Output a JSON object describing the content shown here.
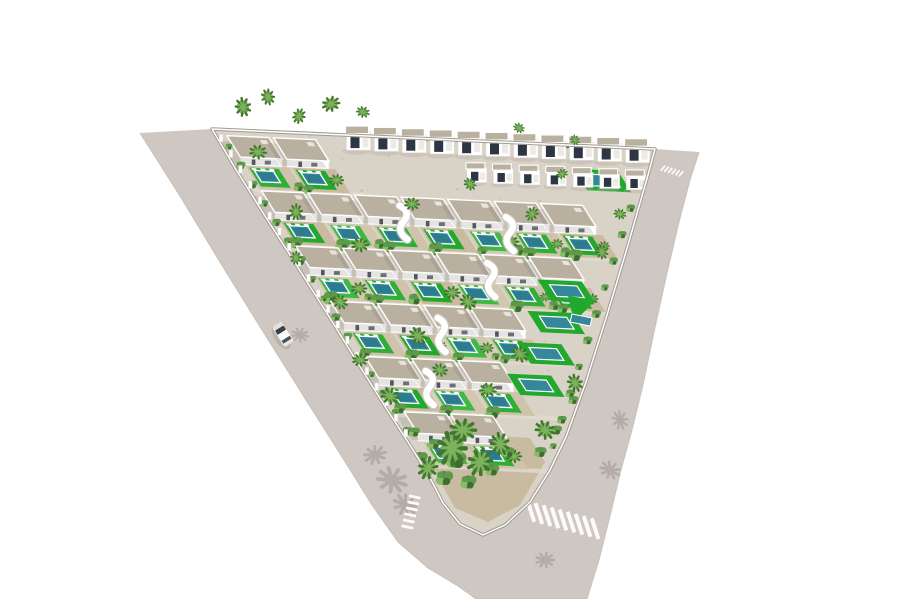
{
  "scene": {
    "type": "3d-architectural-render-aerial-villa-development",
    "canvas": {
      "width": 900,
      "height": 599,
      "background": "#ffffff"
    },
    "seed": 7,
    "colors": {
      "background": "#ffffff",
      "road": "#cfc7c1",
      "roadEdgeLine": "#c2bab3",
      "curb": "#a29a92",
      "curbHighlight": "#ffffff",
      "devStreet": "#d9d2c7",
      "streetBand": "#e1dbd0",
      "sand": [
        "#cfc3ab",
        "#c8bb9f",
        "#d3c7b0"
      ],
      "lawn": [
        "#2fae38",
        "#23a82e",
        "#3db944"
      ],
      "pool": "#35879a",
      "poolDeep": "#2a7487",
      "roof": "#b9b09f",
      "roofBox": "#e9e5dc",
      "facade": "#ffffff",
      "facadeEdge": "#e4e1da",
      "window": "#2d3642",
      "palmDark": "#41762f",
      "palmLight": "#7cb25c",
      "bush1": "#4e8a3f",
      "bush2": "#5e9a4a",
      "bush3": "#8abb66",
      "bush4": "#3c6e30",
      "shadow": "#6f6963",
      "houseShadow": "#b4aba1",
      "carBody": "#f2f1ef",
      "carTrim": "#b9b6b1",
      "carGlass": "#3a4149",
      "stripe": "#ffffff"
    },
    "grid": {
      "origin": [
        212,
        129
      ],
      "u": [
        44.3,
        2.0
      ],
      "v": [
        21.6,
        34.5
      ]
    },
    "devBoundary": [
      [
        212,
        129
      ],
      [
        655,
        149
      ],
      [
        648,
        175
      ],
      [
        628,
        245
      ],
      [
        607,
        315
      ],
      [
        586,
        382
      ],
      [
        566,
        437
      ],
      [
        550,
        470
      ],
      [
        530,
        502
      ],
      [
        505,
        525
      ],
      [
        483,
        535
      ],
      [
        460,
        524
      ],
      [
        443,
        503
      ],
      [
        428,
        474
      ],
      [
        408,
        442
      ],
      [
        386,
        408
      ],
      [
        359,
        365
      ],
      [
        328,
        315
      ],
      [
        297,
        266
      ],
      [
        265,
        216
      ],
      [
        235,
        168
      ]
    ],
    "roadOuter": [
      [
        140,
        133
      ],
      [
        180,
        196
      ],
      [
        226,
        272
      ],
      [
        262,
        330
      ],
      [
        306,
        400
      ],
      [
        344,
        460
      ],
      [
        372,
        505
      ],
      [
        398,
        542
      ],
      [
        428,
        568
      ],
      [
        458,
        586
      ],
      [
        476,
        599
      ],
      [
        587,
        599
      ],
      [
        599,
        560
      ],
      [
        610,
        516
      ],
      [
        621,
        470
      ],
      [
        632,
        430
      ],
      [
        643,
        385
      ],
      [
        654,
        332
      ],
      [
        667,
        273
      ],
      [
        679,
        222
      ],
      [
        690,
        180
      ],
      [
        699,
        152
      ]
    ],
    "rows": [
      {
        "v": 0.18,
        "u0": 0.25,
        "count": 2
      },
      {
        "v": 1.78,
        "u0": 0.25,
        "count": 7
      },
      {
        "v": 3.38,
        "u0": 0.25,
        "count": 6
      },
      {
        "v": 4.98,
        "u0": 0.25,
        "count": 4
      },
      {
        "v": 6.58,
        "u0": 0.25,
        "count": 3
      },
      {
        "v": 8.18,
        "u0": 0.35,
        "count": 2
      }
    ],
    "villa": {
      "pitch": 1.05,
      "roofW": 0.95,
      "roofD": 0.62,
      "facadeDrop": 8
    },
    "backHouses": {
      "v": 0.12,
      "u0": 3.0,
      "pitch": 0.63,
      "count": 11,
      "s": 1.0
    },
    "backHouses2": {
      "v": 0.98,
      "u0": 5.3,
      "pitch": 0.6,
      "count": 7,
      "s": 0.82
    },
    "edgePools": [
      1.0,
      4.35,
      5.3,
      6.25,
      7.2
    ],
    "greenTriangle": [
      [
        568,
        296
      ],
      [
        596,
        300
      ],
      [
        574,
        322
      ]
    ],
    "trianglePool": [
      [
        572,
        314
      ],
      [
        592,
        318
      ],
      [
        590,
        326
      ],
      [
        570,
        322
      ]
    ],
    "tipGardenPoly": [
      [
        432,
        432
      ],
      [
        530,
        438
      ],
      [
        545,
        462
      ],
      [
        520,
        505
      ],
      [
        488,
        522
      ],
      [
        455,
        508
      ],
      [
        436,
        474
      ]
    ],
    "stairs": [
      [
        3.15,
        2.5
      ],
      [
        4.35,
        4.1
      ],
      [
        2.4,
        5.8
      ],
      [
        5.45,
        2.7
      ],
      [
        1.35,
        7.4
      ]
    ],
    "palms": [
      [
        243,
        107,
        1.0
      ],
      [
        268,
        97,
        0.85
      ],
      [
        299,
        116,
        0.8
      ],
      [
        331,
        104,
        0.95
      ],
      [
        363,
        112,
        0.7
      ],
      [
        519,
        128,
        0.6
      ],
      [
        575,
        140,
        0.55
      ],
      [
        360,
        245,
        0.9
      ],
      [
        412,
        204,
        0.8
      ],
      [
        470,
        184,
        0.7
      ],
      [
        532,
        214,
        0.75
      ],
      [
        562,
        174,
        0.6
      ],
      [
        296,
        212,
        0.85
      ],
      [
        258,
        152,
        0.9
      ],
      [
        340,
        302,
        0.85
      ],
      [
        296,
        258,
        0.7
      ],
      [
        418,
        336,
        1.0
      ],
      [
        468,
        302,
        0.9
      ],
      [
        520,
        354,
        0.95
      ],
      [
        575,
        383,
        0.95
      ],
      [
        602,
        252,
        0.75
      ],
      [
        620,
        214,
        0.65
      ],
      [
        390,
        396,
        1.0
      ],
      [
        360,
        360,
        0.8
      ],
      [
        488,
        390,
        0.9
      ],
      [
        545,
        430,
        1.1
      ],
      [
        440,
        370,
        0.8
      ],
      [
        452,
        448,
        1.9
      ],
      [
        480,
        462,
        1.5
      ],
      [
        428,
        468,
        1.2
      ],
      [
        500,
        444,
        1.2
      ],
      [
        463,
        430,
        1.4
      ]
    ],
    "bushes": [
      [
        420,
        458,
        1.2
      ],
      [
        444,
        478,
        1.4
      ],
      [
        468,
        482,
        1.3
      ],
      [
        492,
        470,
        1.1
      ],
      [
        508,
        452,
        1.0
      ],
      [
        434,
        444,
        1.0
      ],
      [
        414,
        432,
        0.9
      ],
      [
        456,
        460,
        1.6
      ],
      [
        540,
        452,
        1.0
      ],
      [
        556,
        430,
        0.9
      ],
      [
        573,
        400,
        0.8
      ],
      [
        300,
        290,
        0.9
      ],
      [
        268,
        236,
        0.8
      ],
      [
        240,
        185,
        0.8
      ]
    ],
    "roadShadows": [
      [
        392,
        480,
        1.6,
        20
      ],
      [
        375,
        455,
        1.2,
        -15
      ],
      [
        405,
        505,
        1.3,
        40
      ],
      [
        300,
        335,
        0.9,
        10
      ],
      [
        620,
        420,
        1.0,
        70
      ],
      [
        610,
        470,
        1.1,
        30
      ],
      [
        545,
        560,
        1.0,
        0
      ]
    ],
    "crosswalks": [
      {
        "center": [
          411,
          512
        ],
        "count": 6,
        "spacing": 6.2,
        "len": 12,
        "w": 2.8,
        "stripeAngle": 12,
        "stepAngle": 104
      },
      {
        "center": [
          563,
          520
        ],
        "count": 9,
        "spacing": 8.3,
        "len": 22,
        "w": 4.0,
        "stripeAngle": 72,
        "stepAngle": 15
      },
      {
        "center": [
          672,
          171
        ],
        "count": 6,
        "spacing": 3.8,
        "len": 7,
        "w": 1.8,
        "stripeAngle": -50,
        "stepAngle": 17
      }
    ],
    "car": {
      "pos": [
        283,
        334
      ],
      "angle": 58
    },
    "pillars": {
      "vStart": 0.3,
      "vEnd": 9.0,
      "step": 0.45,
      "u": 0.06
    },
    "hedge": {
      "vStart": 0.5,
      "vEnd": 9.0,
      "step": 0.55,
      "u": 0.13
    },
    "textureDots": 150
  }
}
